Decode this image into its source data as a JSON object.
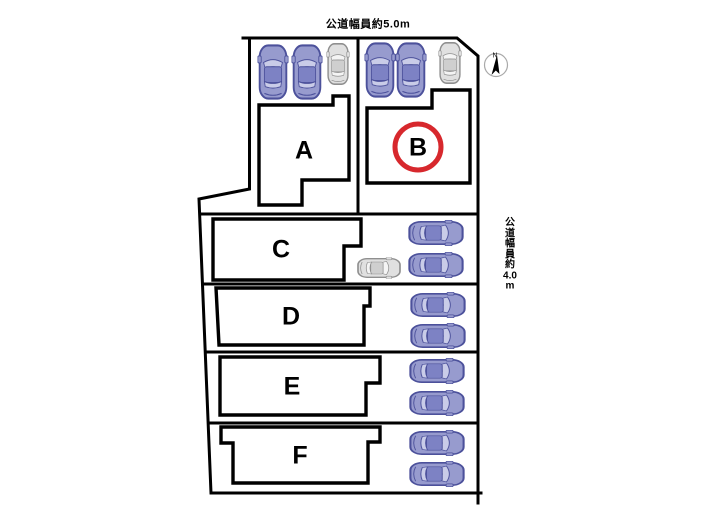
{
  "roads": {
    "top_label": "公道幅員約5.0m",
    "right_label": "公\n道\n幅\n員\n約\n4.0\nm"
  },
  "compass": {
    "north_label": "N"
  },
  "lots": [
    {
      "label": "A",
      "highlighted": false
    },
    {
      "label": "B",
      "highlighted": true
    },
    {
      "label": "C",
      "highlighted": false
    },
    {
      "label": "D",
      "highlighted": false
    },
    {
      "label": "E",
      "highlighted": false
    },
    {
      "label": "F",
      "highlighted": false
    }
  ],
  "parking": {
    "lot_a": {
      "blue_cars": 2,
      "gray_cars": 1
    },
    "lot_b": {
      "blue_cars": 2,
      "gray_cars": 1
    },
    "lot_c": {
      "blue_cars": 2,
      "gray_cars": 1
    },
    "lot_d": {
      "blue_cars": 2,
      "gray_cars": 0
    },
    "lot_e": {
      "blue_cars": 2,
      "gray_cars": 0
    },
    "lot_f": {
      "blue_cars": 2,
      "gray_cars": 0
    }
  },
  "colors": {
    "outline": "#000000",
    "highlight_circle": "#d7282d",
    "car_blue": "#979bce",
    "car_blue_outline": "#4c519b",
    "car_gray": "#e0e0e0",
    "car_gray_outline": "#8f8f8f"
  }
}
